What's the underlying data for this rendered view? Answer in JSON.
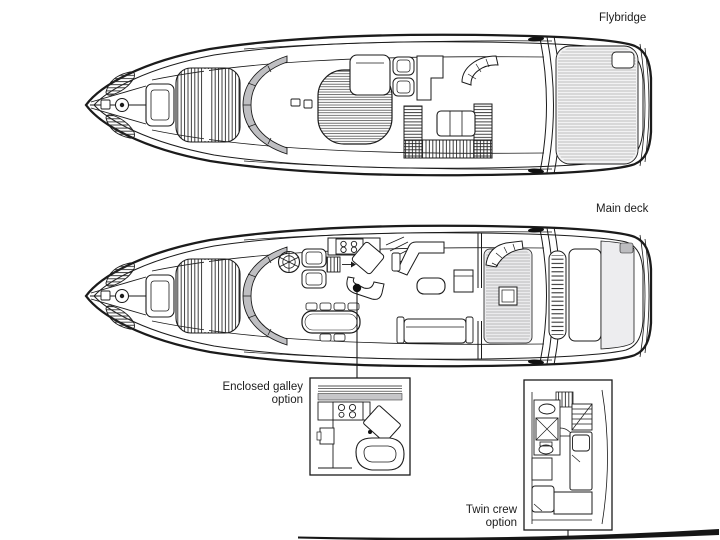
{
  "diagram_type": "yacht-deck-plan",
  "background": "#ffffff",
  "colors": {
    "line": "#1b1b1b",
    "windscreen_glass": "#bfbfc2",
    "panel_light_gray": "#ededef",
    "teak_deck": "#f2f2f3",
    "callout_marker": "#111111"
  },
  "decks": [
    {
      "id": "flybridge",
      "label": "Flybridge"
    },
    {
      "id": "main-deck",
      "label": "Main deck"
    }
  ],
  "options": [
    {
      "id": "enclosed-galley",
      "label": [
        "Enclosed galley",
        "option"
      ]
    },
    {
      "id": "twin-crew",
      "label": [
        "Twin crew",
        "option"
      ]
    }
  ],
  "icons": {
    "anchor_windlass": "circle-capstan",
    "helm_wheel": "segmented-ring",
    "stove_burners": "four-circles-2x2",
    "shower": "square-with-x",
    "toilet": "oval-with-tank",
    "sink": "oval-in-cabinet",
    "stairs": "striped-steps",
    "sunpad": "striped-cushion"
  }
}
